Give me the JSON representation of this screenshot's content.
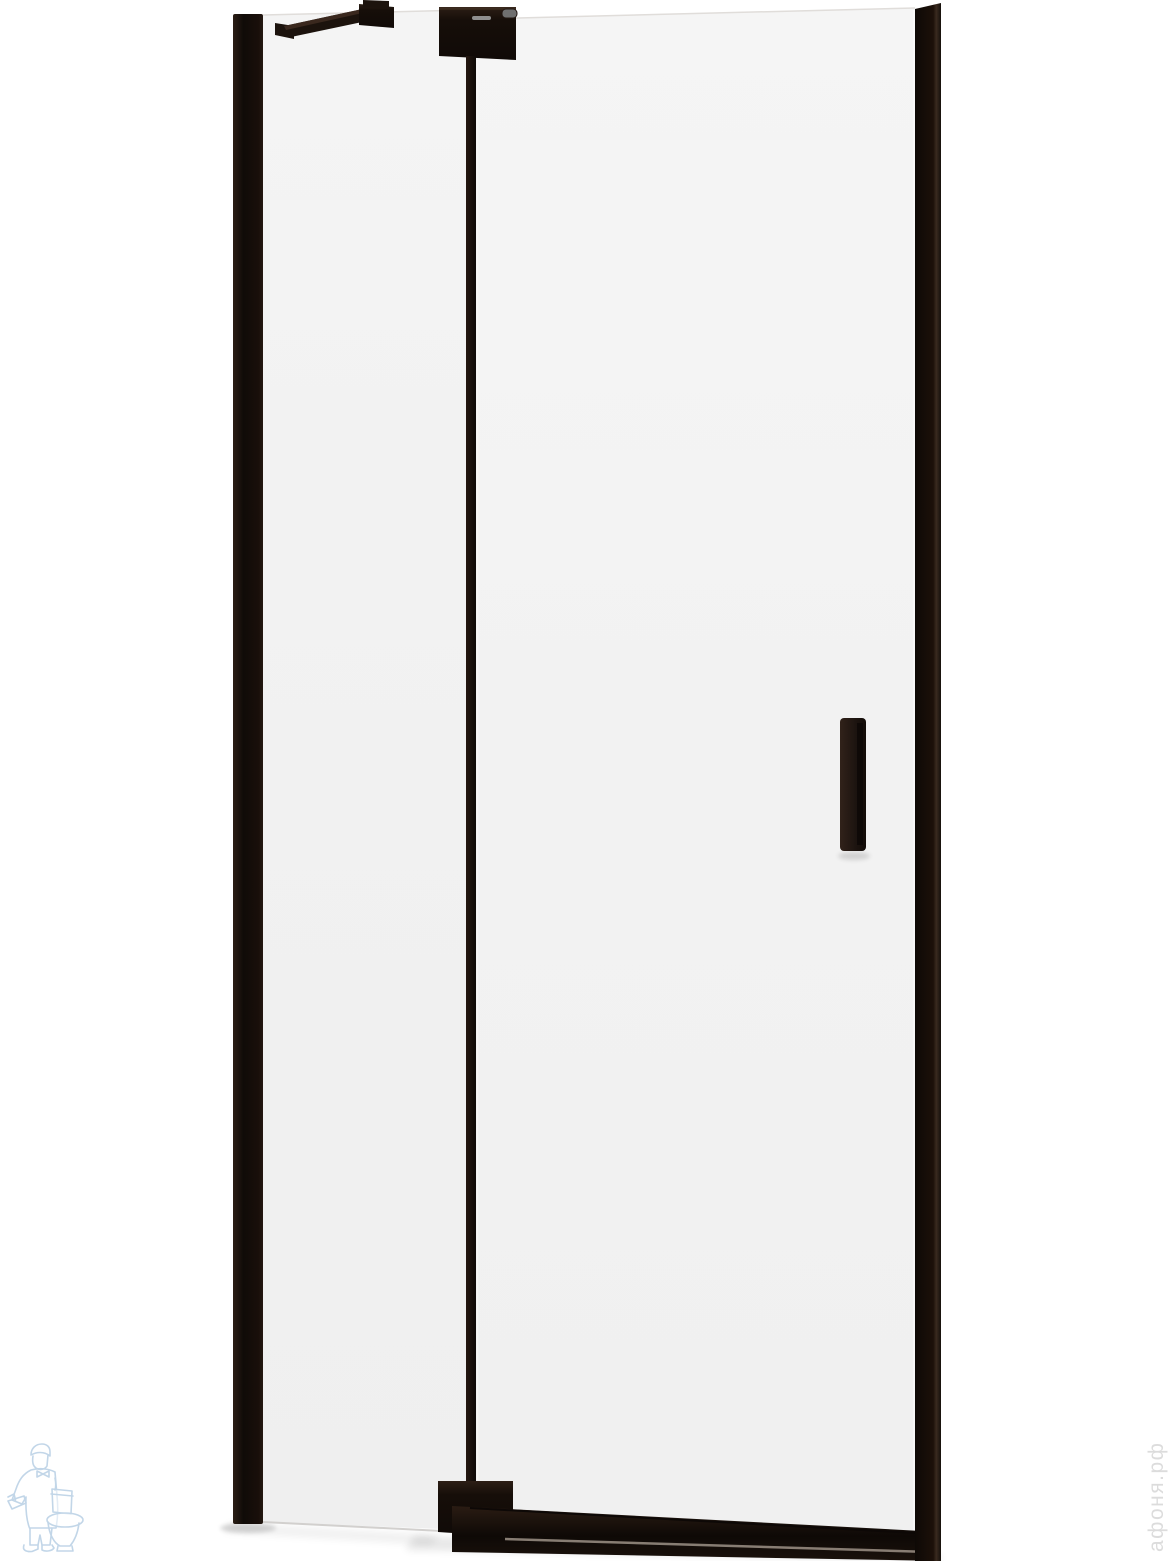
{
  "image": {
    "description": "Product photo: hinged shower door with matte black profiles and clear glass",
    "width_px": 1170,
    "height_px": 1561
  },
  "product_parts": {
    "wall_profile": "left wall profile",
    "fixed_panel_glass": "fixed glass panel",
    "door_glass": "hinged door glass",
    "stabilizer_bar": "top stabilizer support bar",
    "top_hinge": "top pivot hinge block",
    "bottom_hinge": "bottom pivot hinge block",
    "hinge_profile": "vertical hinge-side profile",
    "door_handle": "vertical door handle",
    "threshold_profile": "bottom threshold profile",
    "right_profile": "right door profile"
  },
  "watermarks": {
    "store_text_vertical": "афоня.рф",
    "logo": "plumber-with-toilet-logo"
  },
  "colors": {
    "background": "#ffffff",
    "frame_black": "#1c130d",
    "frame_darkest": "#0f0a07",
    "frame_edge_light": "#3f2d22",
    "glass_fixed": "#f0f0f0",
    "glass_door": "#f3f3f3",
    "glass_edge": "#e0ddda",
    "hinge_slot_gray": "#8f8f8f",
    "hinge_pin_gray": "#6f6f6f",
    "threshold_highlight": "#958a80",
    "shadow_gray": "#000000",
    "watermark_blue": "#bcd2e6",
    "watermark_gray": "#d6d6d6"
  }
}
